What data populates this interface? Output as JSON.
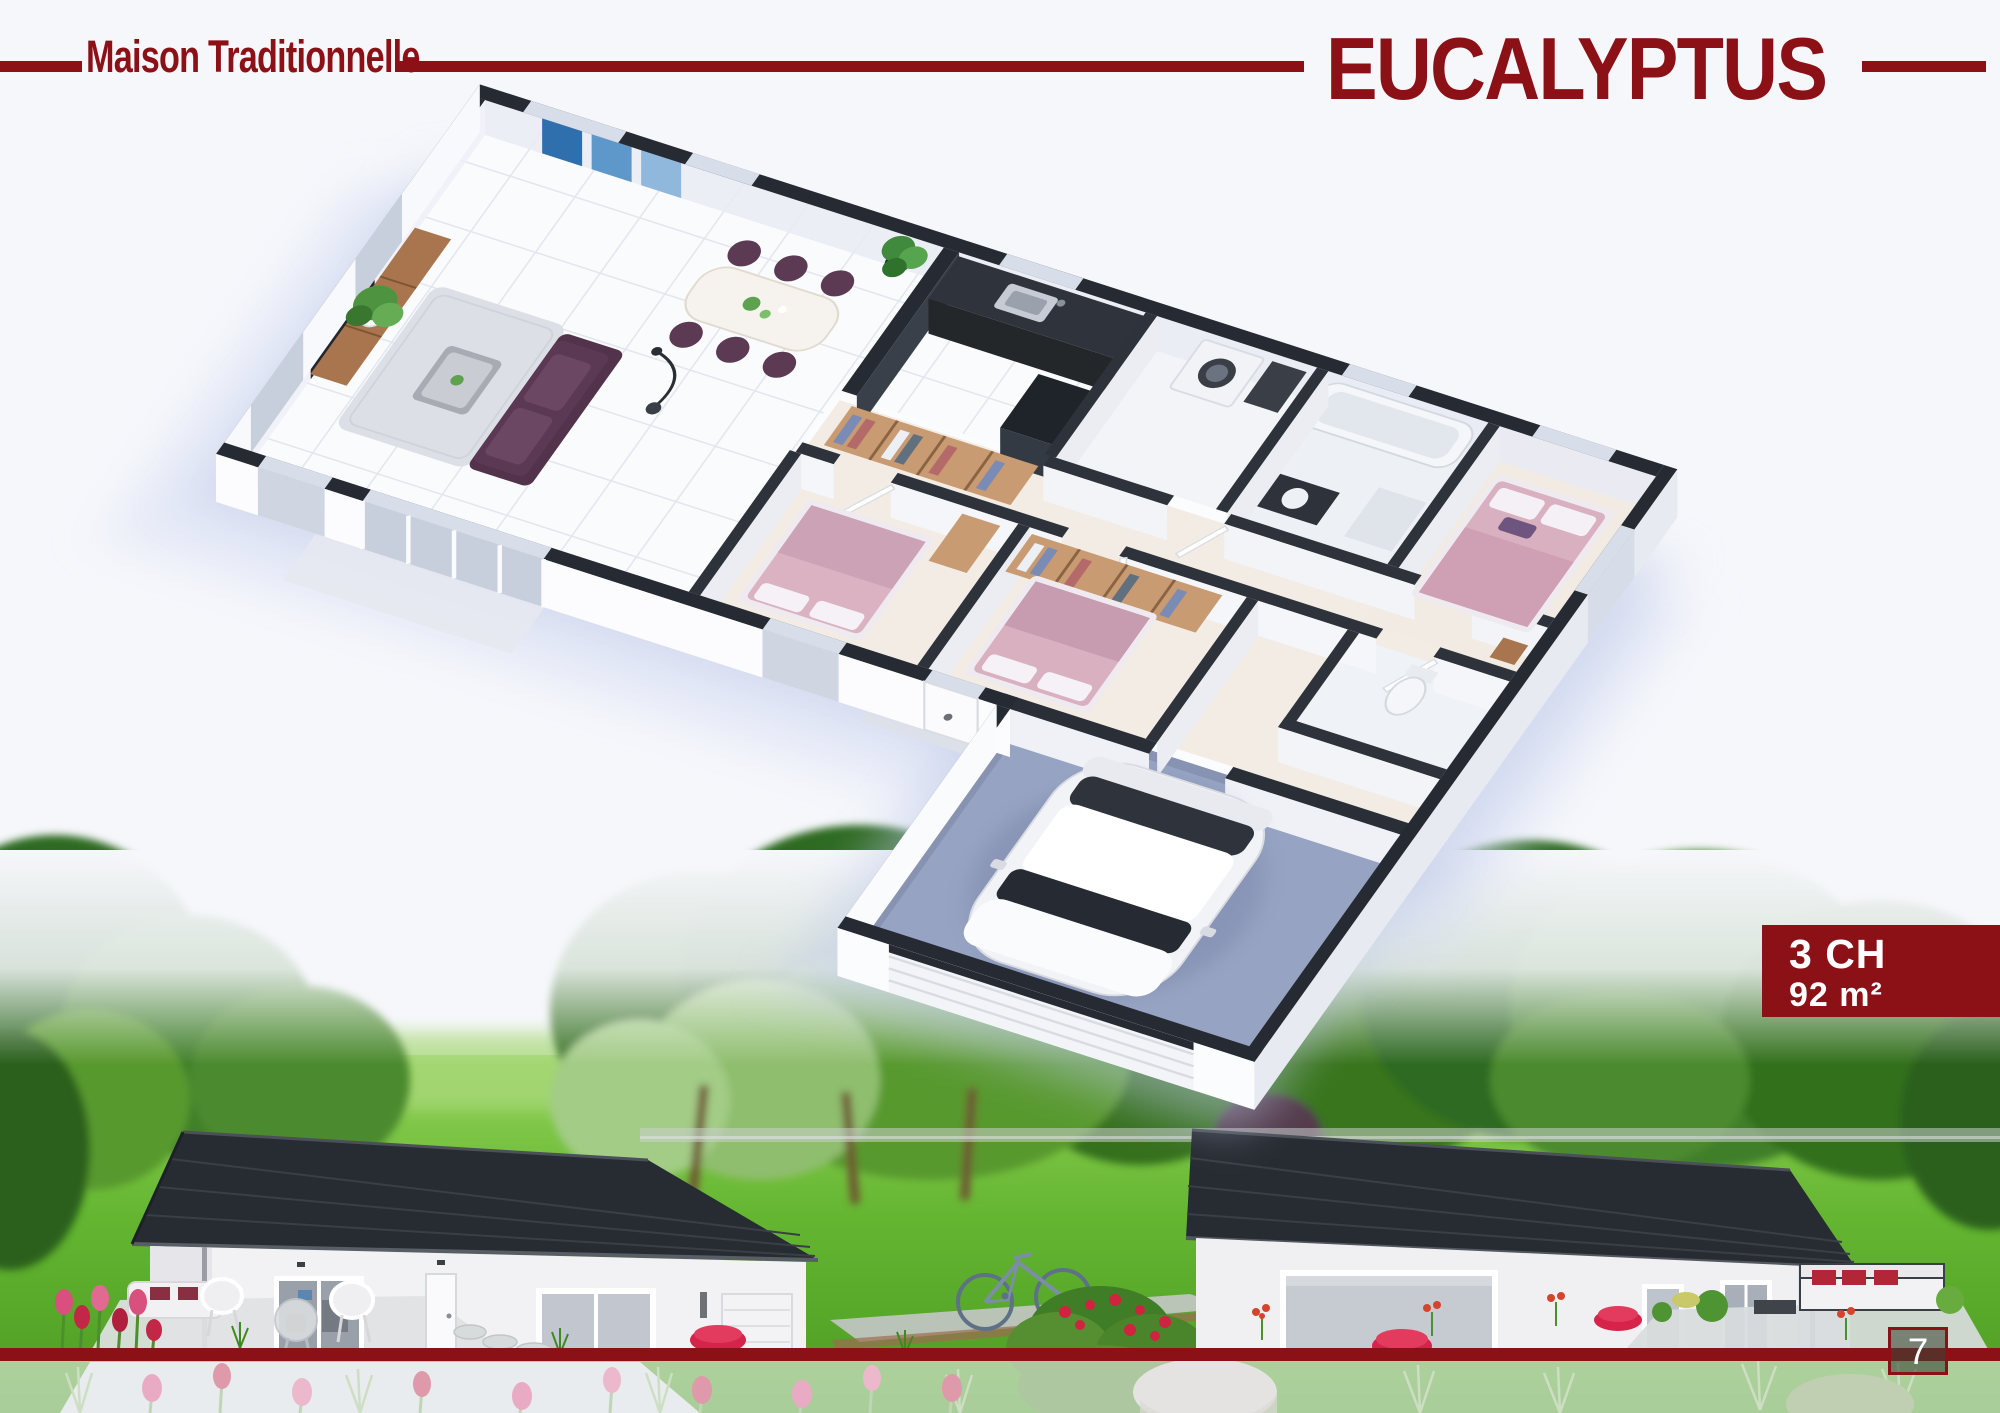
{
  "header": {
    "series_label": "Maison Traditionnelle",
    "model_name": "EUCALYPTUS"
  },
  "spec_badge": {
    "bedrooms": "3 CH",
    "area": "92 m²"
  },
  "footer": {
    "page_number": "7"
  },
  "colors": {
    "accent": "#8B1117",
    "background": "#F6F7FB",
    "wall_cap": "#262A32",
    "roof": "#272B32",
    "grass": "#5FB32F",
    "bedroom_pink": "#D9B0C0",
    "sofa_plum": "#5B3853",
    "garage_floor": "#97A3C2"
  },
  "illustrations": {
    "floorplan": "isometric-3d-floorplan-render",
    "garden": "two-exterior-house-views-with-garden"
  }
}
